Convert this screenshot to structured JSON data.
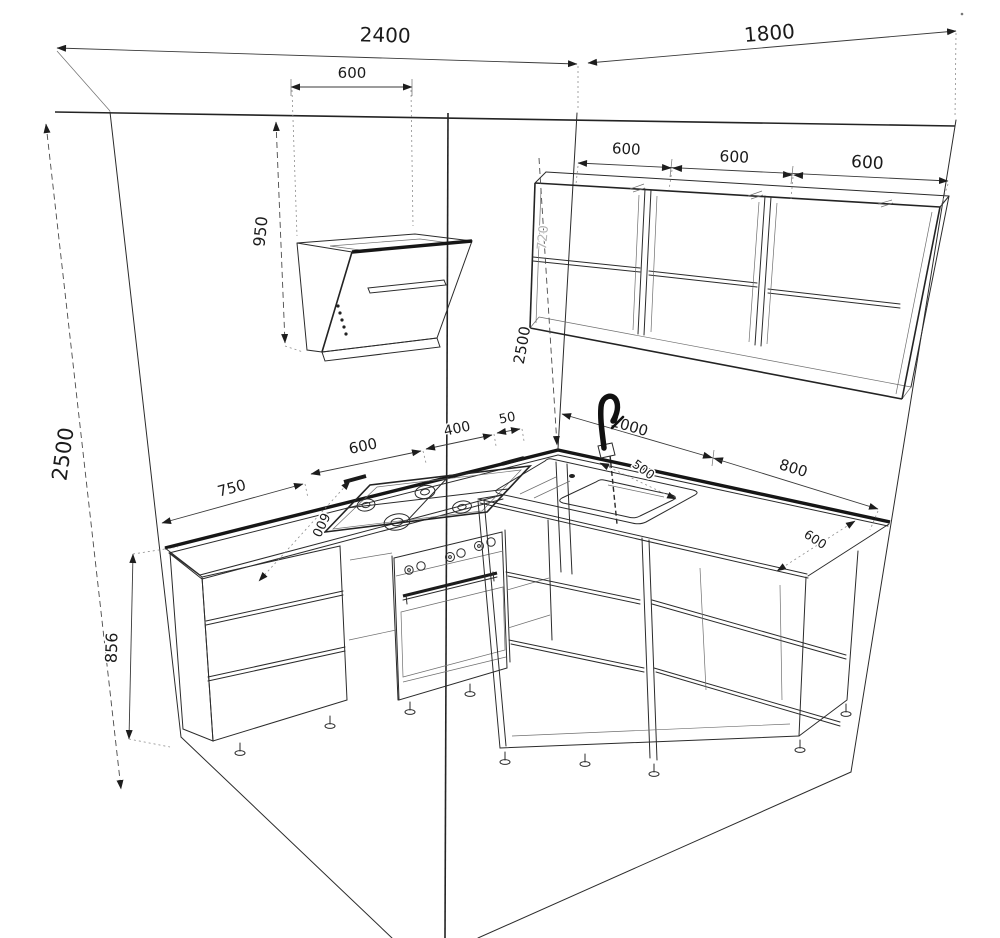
{
  "drawing": {
    "kind": "kitchen-furniture-dimension-drawing",
    "background_color": "#ffffff",
    "line_color": "#2b2b2b",
    "components": [
      "left-wall",
      "right-wall",
      "floor",
      "range-hood",
      "wall-cabinets",
      "gas-hob",
      "oven",
      "sink",
      "faucet",
      "base-cabinets",
      "countertop"
    ],
    "dims": {
      "w2400": "2400",
      "w1800": "1800",
      "hood600": "600",
      "h950": "950",
      "h2500_left": "2500",
      "h2500_corner": "2500",
      "u600a": "600",
      "u600b": "600",
      "u600c": "600",
      "h720": "720",
      "b750": "750",
      "b600": "600",
      "b400": "400",
      "b50": "50",
      "dleft600": "600",
      "sink1000": "1000",
      "sink500": "500",
      "b800": "800",
      "dright600": "600",
      "h856": "856"
    }
  }
}
